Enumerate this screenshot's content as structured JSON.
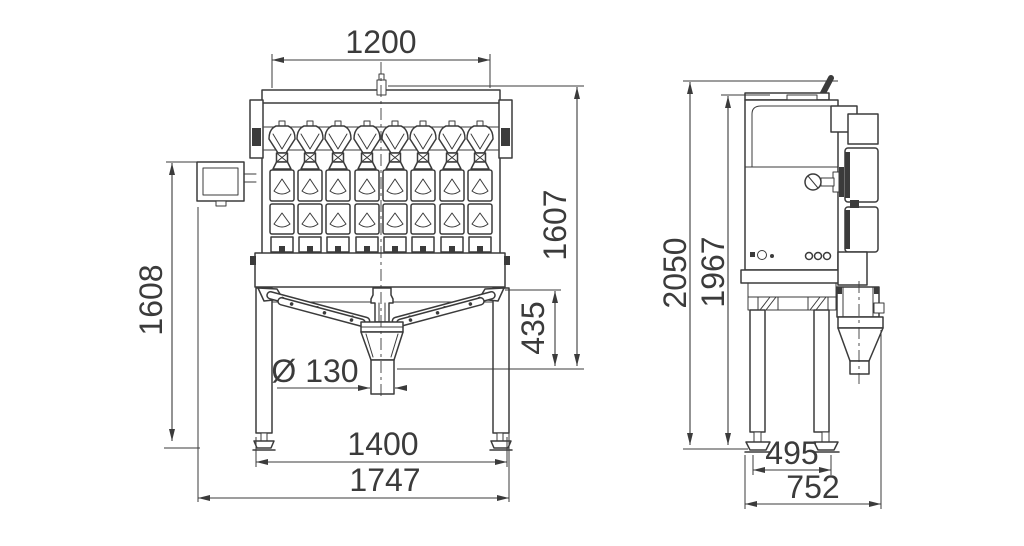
{
  "colors": {
    "line": "#3b3b3b",
    "background": "#ffffff"
  },
  "front_view": {
    "dimensions": {
      "top_width": "1200",
      "total_height": "1607",
      "left_height": "1608",
      "discharge_height": "435",
      "outlet_diameter": "Ø 130",
      "leg_span": "1400",
      "overall_width": "1747"
    }
  },
  "side_view": {
    "dimensions": {
      "overall_height": "2050",
      "frame_height": "1967",
      "leg_span": "495",
      "overall_depth": "752"
    }
  }
}
